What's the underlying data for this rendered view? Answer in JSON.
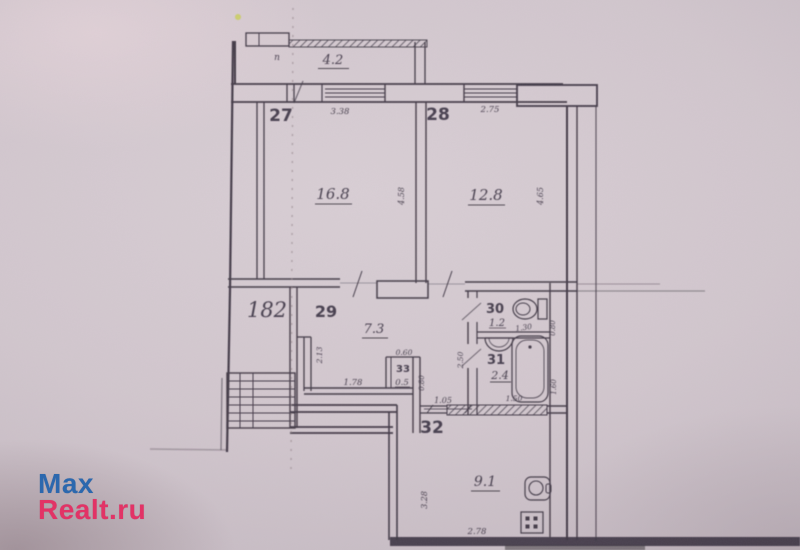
{
  "watermark": {
    "line1": "Max",
    "line2": "Realt.ru",
    "blue": "#2c68ae",
    "pink": "#e23366"
  },
  "plan": {
    "type": "apartment-floor-plan",
    "unit_number": "182",
    "balcony": {
      "area": "4.2",
      "corner_mark": "п"
    },
    "rooms": [
      {
        "number": "27",
        "area": "16.8"
      },
      {
        "number": "28",
        "area": "12.8"
      },
      {
        "number": "29",
        "area": "7.3"
      },
      {
        "number": "30",
        "area": "1.2"
      },
      {
        "number": "31",
        "area": "2.4"
      },
      {
        "number": "32",
        "area": "9.1"
      },
      {
        "number": "33",
        "area": "0.5"
      }
    ],
    "dimensions": {
      "room27_width": "3.38",
      "room27_depth": "4.58",
      "room28_width": "2.75",
      "room28_depth": "4.65",
      "hall_height": "2.13",
      "hall_width": "1.78",
      "closet_width": "0.60",
      "closet_depth": "0.80",
      "kitchen_passage": "1.05",
      "wc_width": "1.30",
      "wc_depth": "0.80",
      "san_block_depth": "2.50",
      "bath_width": "1.50",
      "tub_length": "1.60",
      "kitchen_depth": "3.28",
      "kitchen_width": "2.78"
    },
    "icons": [
      "toilet",
      "washbasin",
      "bathtub",
      "kitchen-sink",
      "stove",
      "staircase"
    ]
  }
}
